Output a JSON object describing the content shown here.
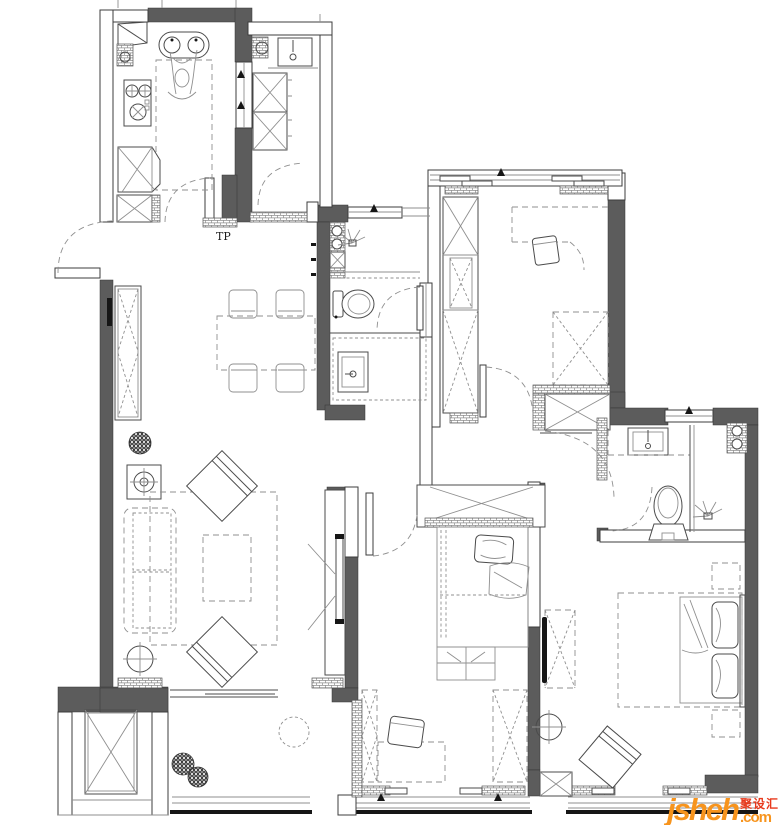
{
  "labels": {
    "pipe_shaft": "TP"
  },
  "watermark": {
    "brand": "jsheh",
    "tld": ".com",
    "cjk": "聚设汇"
  },
  "colors": {
    "wall": "#5c5c5c",
    "light": "#8f8f8f",
    "brand": "#f7941d",
    "cjk": "#e8391c"
  }
}
